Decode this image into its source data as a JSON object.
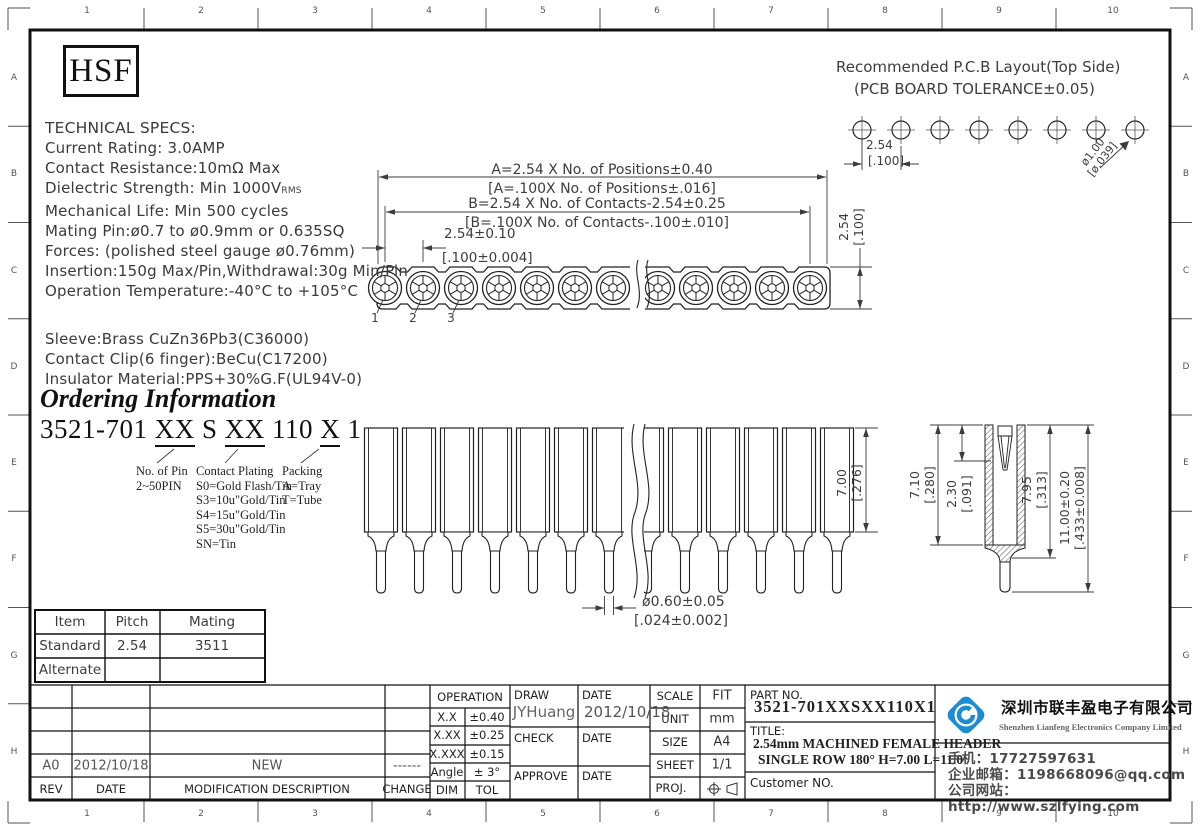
{
  "sheet": {
    "logo": "HSF",
    "zone_cols": [
      "1",
      "2",
      "3",
      "4",
      "5",
      "6",
      "7",
      "8",
      "9",
      "10"
    ],
    "zone_rows": [
      "A",
      "B",
      "C",
      "D",
      "E",
      "F",
      "G",
      "H"
    ]
  },
  "specs": {
    "title": "TECHNICAL SPECS:",
    "lines_a": [
      "Current Rating: 3.0AMP",
      "Contact Resistance:10mΩ Max"
    ],
    "dielectric_prefix": "Dielectric Strength: Min 1000V",
    "dielectric_sub": "RMS",
    "lines_b": [
      "Mechanical Life: Min 500 cycles",
      "Mating Pin:ø0.7 to ø0.9mm or 0.635SQ",
      "Forces: (polished steel gauge ø0.76mm)",
      "Insertion:150g Max/Pin,Withdrawal:30g Min/Pin",
      "Operation Temperature:-40°C to +105°C"
    ],
    "materials": [
      "Sleeve:Brass CuZn36Pb3(C36000)",
      "Contact Clip(6 finger):BeCu(C17200)",
      "Insulator Material:PPS+30%G.F(UL94V-0)"
    ]
  },
  "ordering": {
    "title": "Ordering Information",
    "code": {
      "p0": "3521-701 ",
      "u1": "XX",
      "p1": " S ",
      "u2": "XX",
      "p2": " 110 ",
      "u3": "X",
      "p3": " 1"
    },
    "pin_group": {
      "title": "No. of Pin",
      "lines": [
        "2~50PIN"
      ]
    },
    "plating_group": {
      "title": "Contact Plating",
      "lines": [
        "S0=Gold Flash/Tin",
        "S3=10u\"Gold/Tin",
        "S4=15u\"Gold/Tin",
        "S5=30u\"Gold/Tin",
        "SN=Tin"
      ]
    },
    "packing_group": {
      "title": "Packing",
      "lines": [
        "A=Tray",
        "T=Tube"
      ]
    }
  },
  "pcb": {
    "title1": "Recommended P.C.B Layout(Top Side)",
    "title2": "(PCB BOARD TOLERANCE±0.05)",
    "pitch_mm": "2.54",
    "pitch_in": "[.100]",
    "hole_mm": "ø1.00",
    "hole_in": "[ø.039]"
  },
  "top_view": {
    "dim_a_mm": "A=2.54 X No. of Positions±0.40",
    "dim_a_in": "[A=.100X No. of Positions±.016]",
    "dim_b_mm": "B=2.54 X No. of Contacts-2.54±0.25",
    "dim_b_in": "[B=.100X No. of Contacts-.100±.010]",
    "dim_pitch_mm": "2.54±0.10",
    "dim_pitch_in": "[.100±0.004]",
    "dim_w_mm": "2.54",
    "dim_w_in": "[.100]",
    "pins": [
      "1",
      "2",
      "3"
    ]
  },
  "front_view": {
    "dim_h_mm": "7.00",
    "dim_h_in": "[.276]",
    "dim_pin_mm": "ø0.60±0.05",
    "dim_pin_in": "[.024±0.002]"
  },
  "section_view": {
    "dim_ins_mm": "7.10",
    "dim_ins_in": "[.280]",
    "dim_entry_mm": "2.30",
    "dim_entry_in": "[.091]",
    "dim_sleeve_mm": "7.95",
    "dim_sleeve_in": "[.313]",
    "dim_total_mm": "11.00±0.20",
    "dim_total_in": "[.433±0.008]"
  },
  "mating_table": {
    "headers": [
      "Item",
      "Pitch",
      "Mating"
    ],
    "rows": [
      [
        "Standard",
        "2.54",
        "3511"
      ],
      [
        "Alternate",
        "",
        ""
      ]
    ]
  },
  "revision_table": {
    "headers": [
      "REV",
      "DATE",
      "MODIFICATION DESCRIPTION",
      "CHANGE"
    ],
    "rows": [
      [
        "A0",
        "2012/10/18",
        "NEW",
        "------"
      ]
    ]
  },
  "tolerance_table": {
    "title": "OPERATION",
    "rows": [
      [
        "X.X",
        "±0.40"
      ],
      [
        "X.XX",
        "±0.25"
      ],
      [
        "X.XXX",
        "±0.15"
      ],
      [
        "Angle",
        "± 3°"
      ],
      [
        "DIM",
        "TOL"
      ]
    ]
  },
  "signoff": {
    "draw_label": "DRAW",
    "draw_name": "JYHuang",
    "date_label": "DATE",
    "draw_date": "2012/10/18",
    "check_label": "CHECK",
    "approve_label": "APPROVE"
  },
  "info": {
    "scale_label": "SCALE",
    "scale": "FIT",
    "unit_label": "UNIT",
    "unit": "mm",
    "size_label": "SIZE",
    "size": "A4",
    "sheet_label": "SHEET",
    "sheet": "1/1",
    "proj_label": "PROJ."
  },
  "part": {
    "no_label": "PART NO.",
    "no": "3521-701XXSXX110X1",
    "title_label": "TITLE:",
    "title1": "2.54mm MACHINED FEMALE HEADER",
    "title2": "SINGLE ROW 180° H=7.00 L=11.0",
    "customer_label": "Customer NO."
  },
  "company": {
    "cn": "深圳市联丰盈电子有限公司",
    "en": "Shenzhen Lianfeng Electronics Company Limited",
    "phone": "手机：17727597631",
    "email": "企业邮箱：1198668096@qq.com",
    "site": "公司网站：http://www.szlfying.com",
    "accent": "#1b8dd0"
  }
}
